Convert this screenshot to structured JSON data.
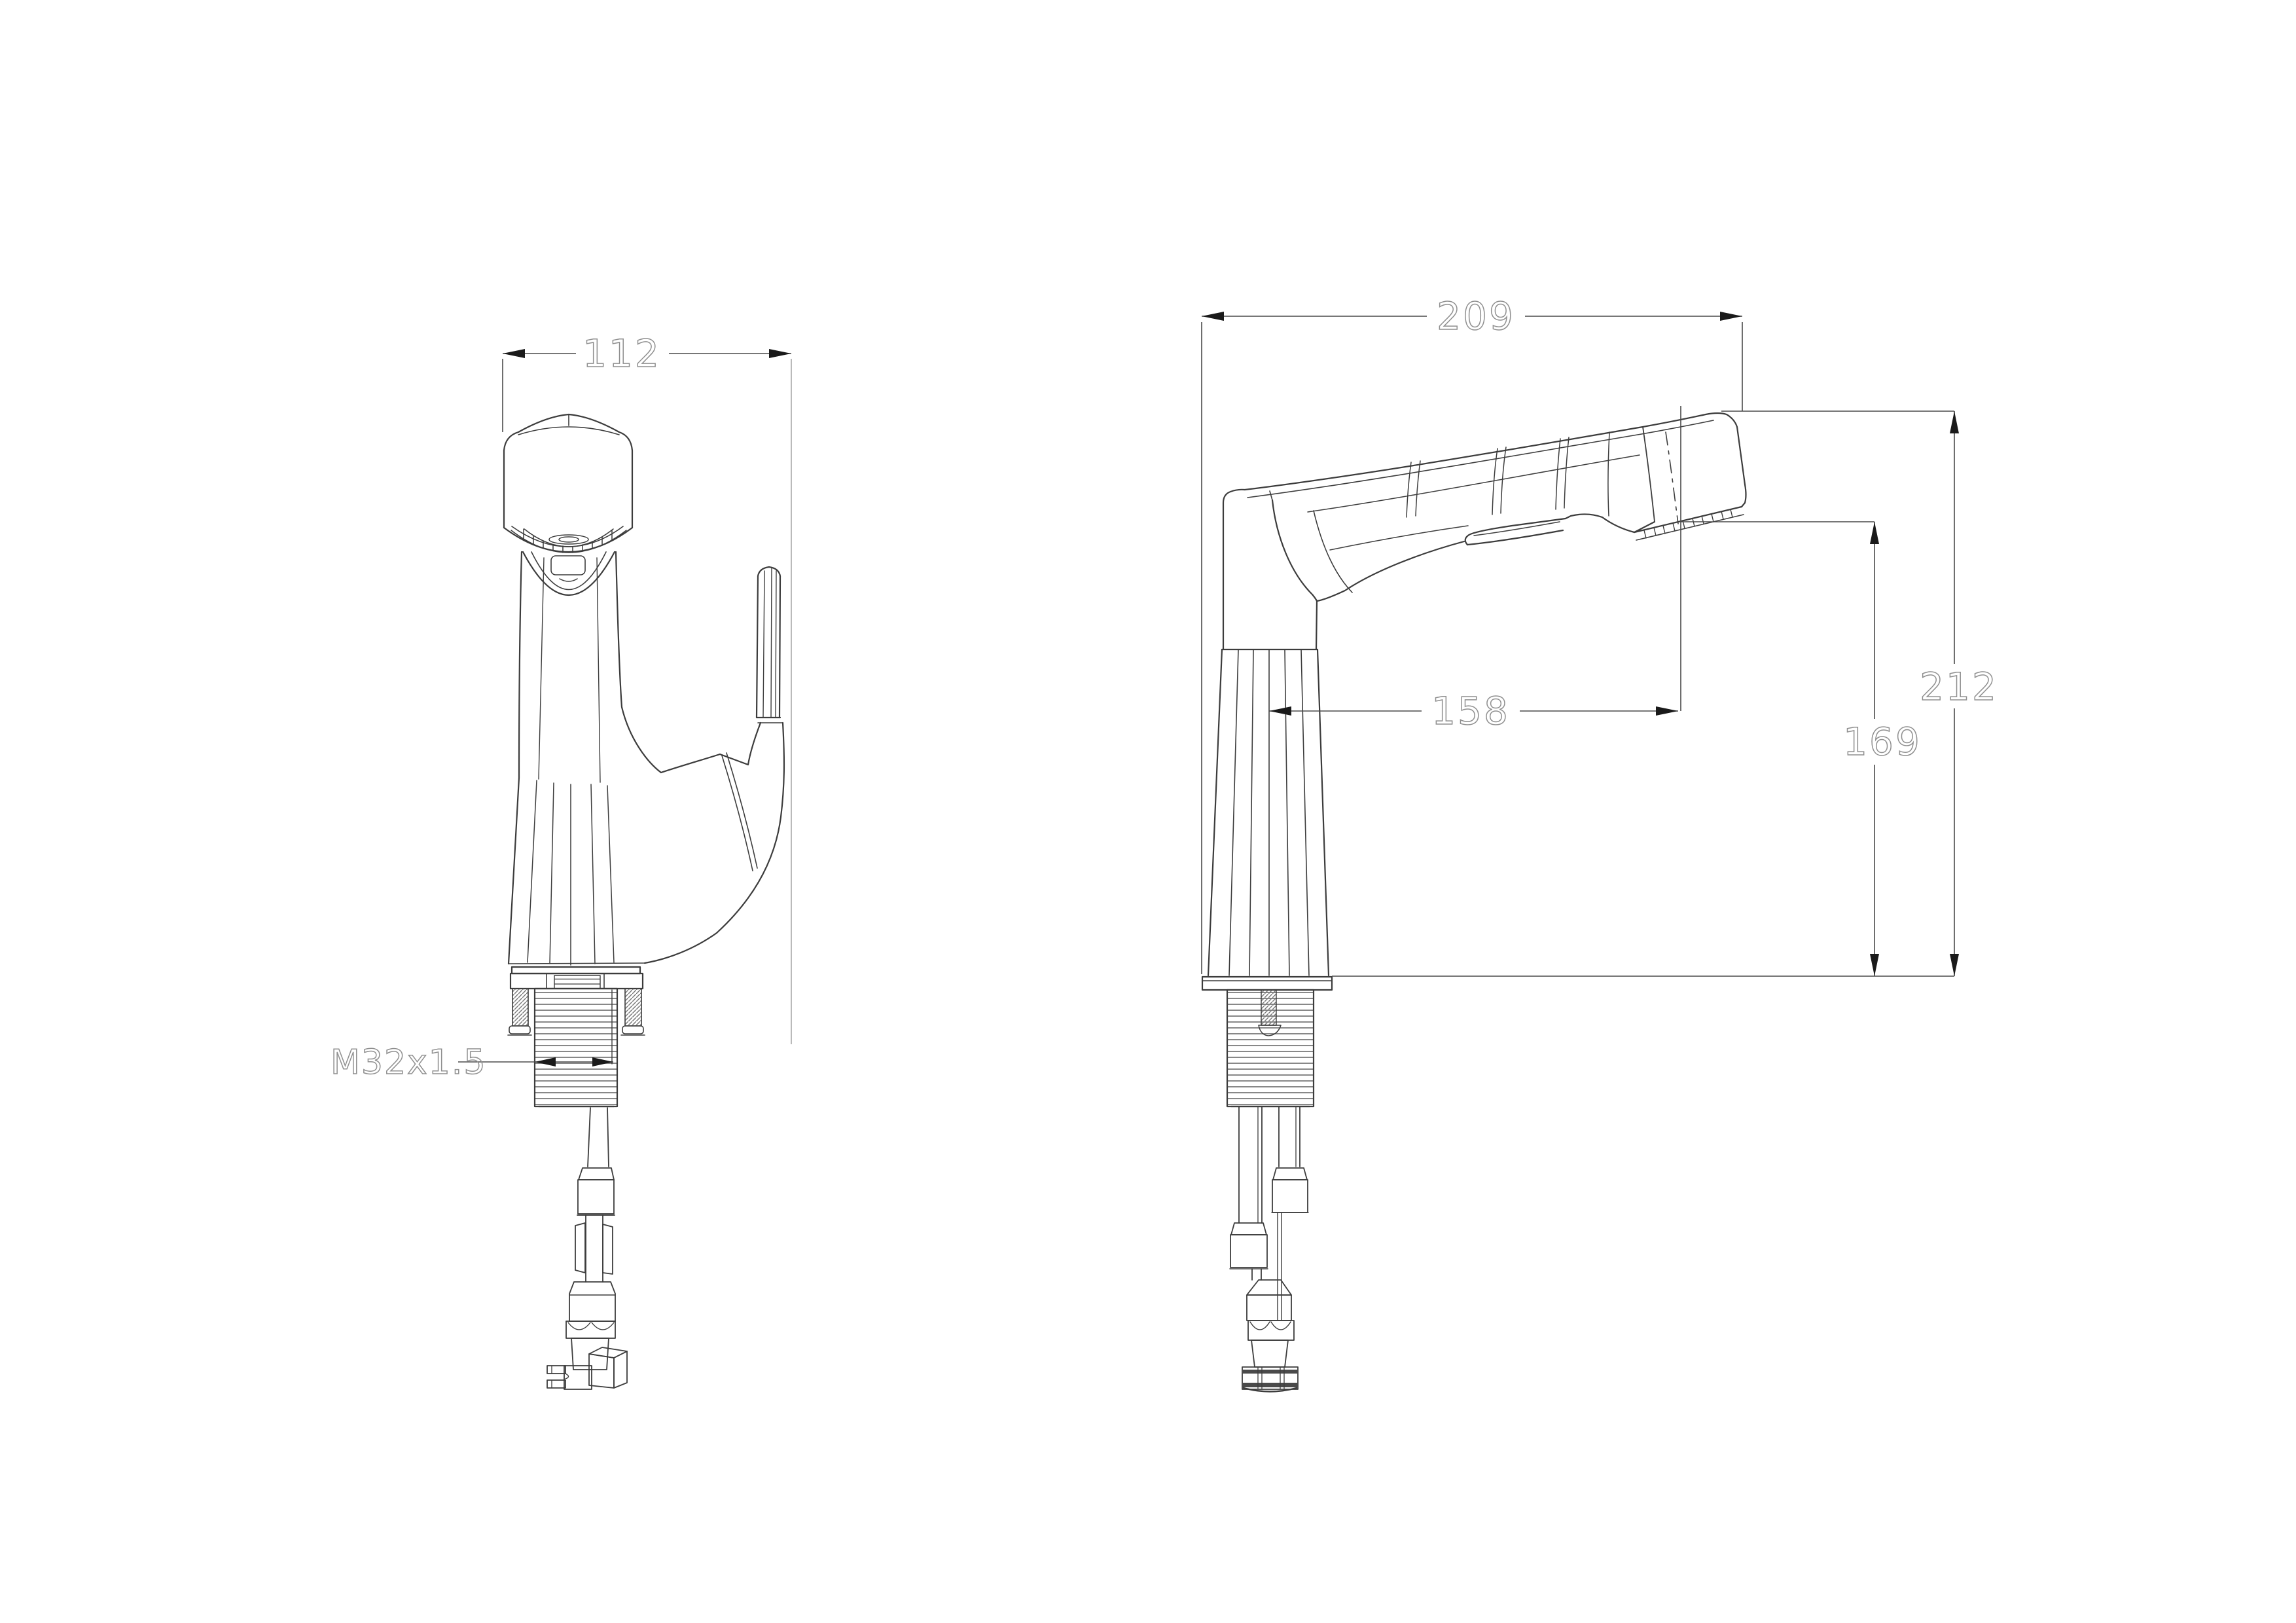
{
  "drawing": {
    "background": "#ffffff",
    "line_color": "#3c3c3c",
    "thin_color": "#5a5a5a",
    "dim_line_color": "#4a4a4a",
    "ext_light_color": "#a8a8a8",
    "dim_text_color": "#8f8f8f",
    "arrow_color": "#1a1a1a",
    "dimensions": {
      "front_width": "112",
      "side_length": "209",
      "spout_reach": "158",
      "spout_height": "169",
      "overall_height": "212",
      "thread_spec": "M32x1.5"
    }
  }
}
